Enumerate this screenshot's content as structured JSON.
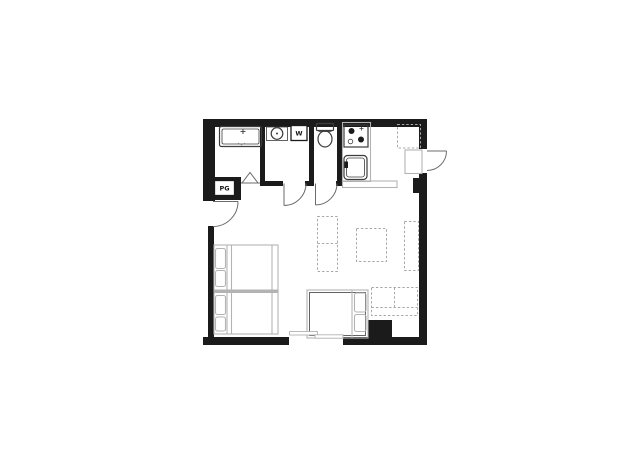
{
  "plan": {
    "labels": {
      "washing_machine": "W",
      "meter_box": "PG"
    },
    "icons": {
      "tub_faucet_icon": "+"
    },
    "colors": {
      "background": "#ffffff",
      "wall": "#1b1b1b",
      "fixture": "#3d3d3d",
      "furniture": "#b3b3b3",
      "dashed": "#a8a8a8",
      "door": "#6b6b6b"
    }
  }
}
